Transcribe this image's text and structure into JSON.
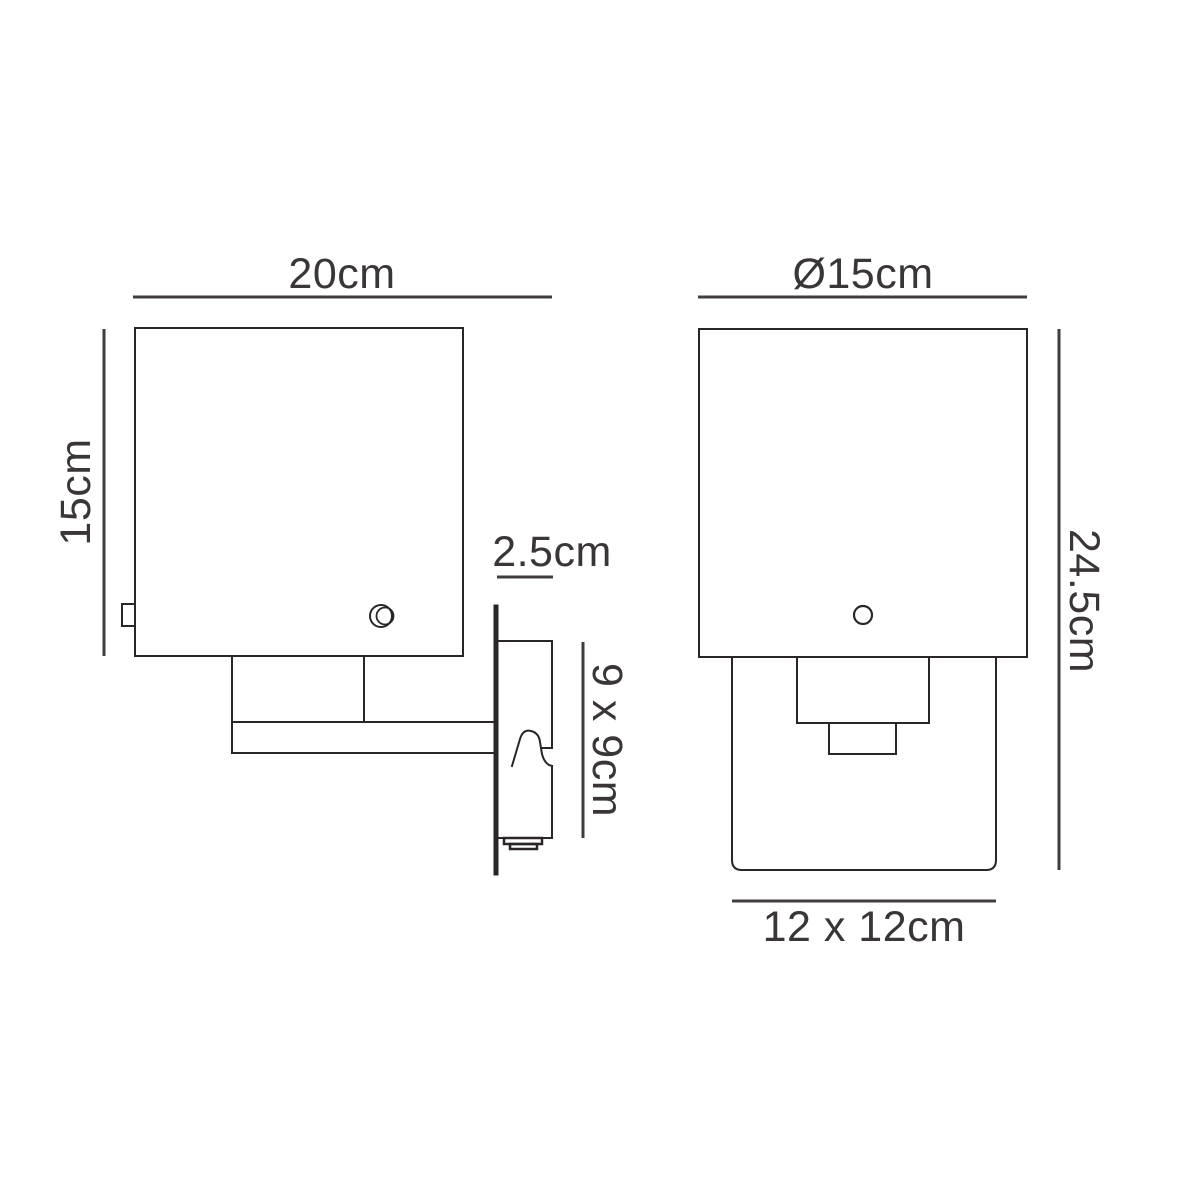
{
  "diagram": {
    "kind": "technical-dimension-drawing",
    "subject": "wall light / sconce shown in side view and front view",
    "colors": {
      "background": "#ffffff",
      "drawing_line": "#2a2627",
      "dimension_line": "#413d3e",
      "label_text": "#3a3637"
    },
    "side_view": {
      "labels": {
        "shade_width": "20cm",
        "shade_height": "15cm",
        "plate_depth": "2.5cm",
        "plate_size": "9 x 9cm"
      }
    },
    "front_view": {
      "labels": {
        "shade_diameter": "Ø15cm",
        "overall_height": "24.5cm",
        "backplate_size": "12 x 12cm"
      }
    }
  }
}
